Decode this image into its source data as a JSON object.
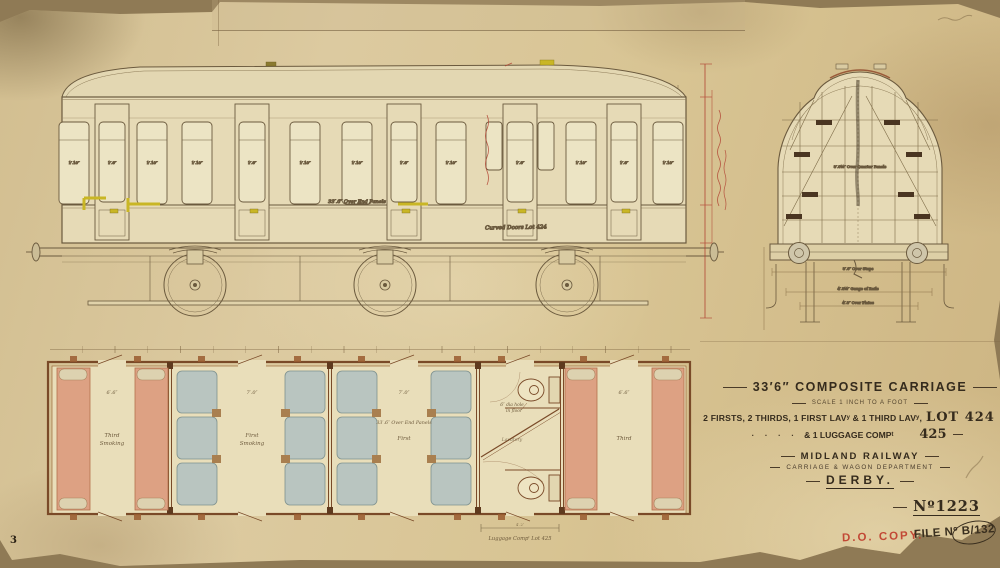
{
  "sheet": {
    "sheet_number": "3",
    "do_copy_stamp": "D.O. COPY.",
    "file_stamp": "FILE Nº B/132"
  },
  "title_block": {
    "title": "33′6″ COMPOSITE CARRIAGE",
    "scale_note": "SCALE 1 INCH TO A FOOT",
    "composition": "2 FIRSTS, 2 THIRDS, 1 FIRST LAVʸ & 1 THIRD LAVʸ,",
    "lot_label": "LOT 424",
    "ditto_prefix": "· · · ·",
    "luggage_line": "& 1 LUGGAGE COMPᵗ",
    "lot2": "425",
    "railway": "MIDLAND RAILWAY",
    "department": "CARRIAGE & WAGON DEPARTMENT",
    "city": "DERBY.",
    "drawing_no": "Nº1223"
  },
  "side_elevation": {
    "over_end_panels": "33′.6″ Over End Panels",
    "curved_doors_note": "Curved Doors Lot 424",
    "window_dim": "1′.10″",
    "door_dim": "1′.6″"
  },
  "end_elevation": {
    "over_quarter_panels": "8′.0½″ Over Quarter Panels",
    "over_steps": "8′.6″ Over Steps",
    "gauge": "4′.8½″ Gauge of Rails",
    "over_plates": "4′.8″ Over Plates"
  },
  "plan": {
    "compartments": [
      {
        "line1": "Third",
        "line2": "Smoking",
        "dim": "6′.6″"
      },
      {
        "line1": "First",
        "line2": "Smoking",
        "dim": "7′.0″"
      },
      {
        "line1": "First",
        "line2": "",
        "dim": "7′.0″"
      },
      {
        "line1": "Lavatory",
        "line2": "",
        "dim": ""
      },
      {
        "line1": "Third",
        "line2": "",
        "dim": "6′.6″"
      }
    ],
    "over_end_panels": "33′.6″ Over End Panels",
    "hole_note1": "6″ dia hole",
    "hole_note2": "in floor",
    "bottom_dim": "4′.2″",
    "luggage_lot_note": "Luggage Compᵗ Lot 425"
  }
}
